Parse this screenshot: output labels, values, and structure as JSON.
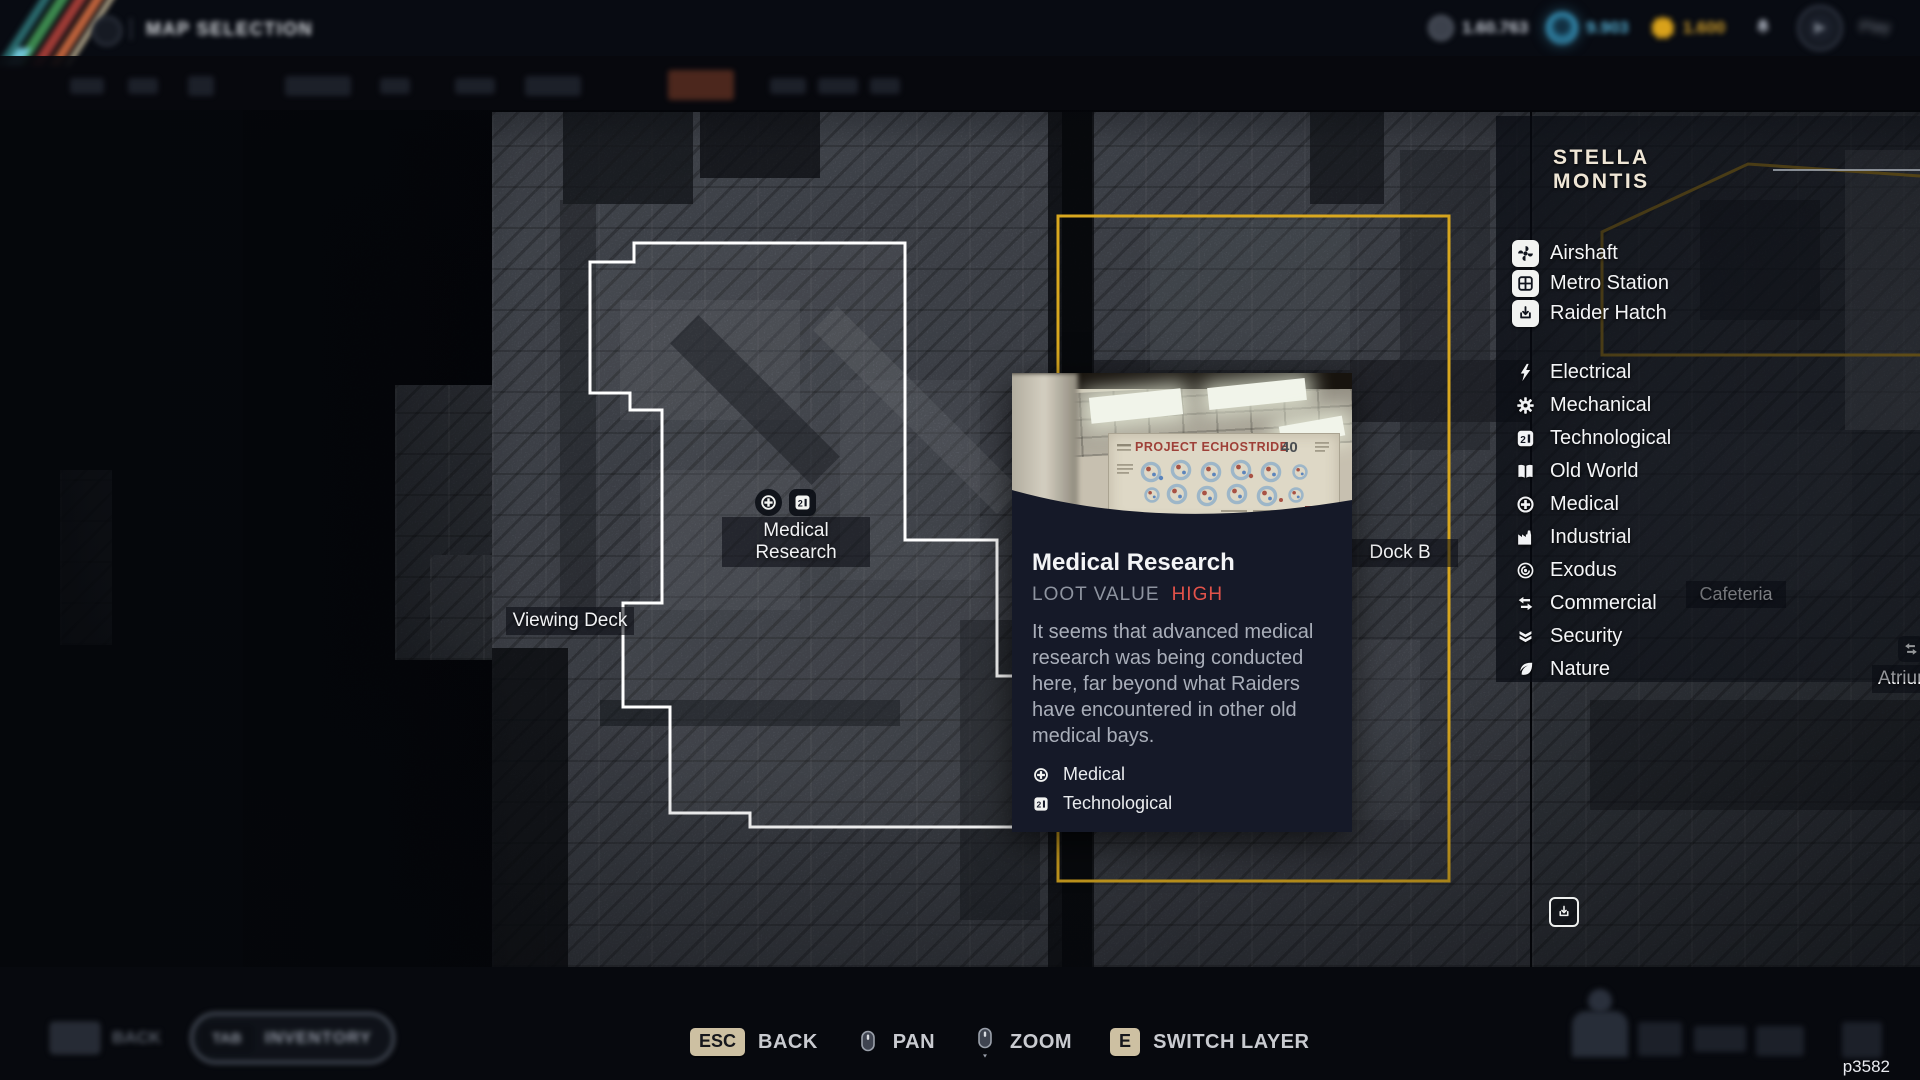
{
  "top_bar": {
    "title": "MAP SELECTION",
    "currencies": [
      {
        "icon": "coin-icon",
        "value": "1.60.763"
      },
      {
        "icon": "energy-orb-icon",
        "value": "9.903",
        "color": "#54aed2"
      },
      {
        "icon": "gold-gear-icon",
        "value": "1.600",
        "color": "#d2a02b"
      }
    ],
    "play_label": "Play"
  },
  "background_hud": {
    "back_label": "BACK",
    "inventory_key": "TAB",
    "inventory_label": "INVENTORY"
  },
  "map": {
    "labels": {
      "medical_research": "Medical Research",
      "viewing_deck": "Viewing Deck",
      "dock_b": "Dock B",
      "cafeteria": "Cafeteria",
      "atrium": "Atrium"
    },
    "colors": {
      "selection": "#d9a81f",
      "room_outline": "#ffffff"
    }
  },
  "tooltip": {
    "title": "Medical Research",
    "loot_label": "LOOT VALUE",
    "loot_value": "HIGH",
    "loot_color": "#e2524a",
    "description": "It seems that advanced medical research was being conducted here, far beyond what Raiders have encountered in other old medical bays.",
    "photo": {
      "poster_title": "PROJECT ECHOSTRIDE",
      "poster_number": "40"
    },
    "tags": [
      {
        "icon": "medical-icon",
        "label": "Medical"
      },
      {
        "icon": "technological-icon",
        "label": "Technological"
      }
    ]
  },
  "legend": {
    "title": "STELLA MONTIS",
    "markers": [
      {
        "icon": "airshaft-icon",
        "label": "Airshaft"
      },
      {
        "icon": "metro-station-icon",
        "label": "Metro Station"
      },
      {
        "icon": "raider-hatch-icon",
        "label": "Raider Hatch"
      }
    ],
    "categories": [
      {
        "icon": "electrical-icon",
        "label": "Electrical"
      },
      {
        "icon": "mechanical-icon",
        "label": "Mechanical"
      },
      {
        "icon": "technological-icon",
        "label": "Technological"
      },
      {
        "icon": "old-world-icon",
        "label": "Old World"
      },
      {
        "icon": "medical-icon",
        "label": "Medical"
      },
      {
        "icon": "industrial-icon",
        "label": "Industrial"
      },
      {
        "icon": "exodus-icon",
        "label": "Exodus"
      },
      {
        "icon": "commercial-icon",
        "label": "Commercial"
      },
      {
        "icon": "security-icon",
        "label": "Security"
      },
      {
        "icon": "nature-icon",
        "label": "Nature"
      }
    ]
  },
  "hints": [
    {
      "key": "ESC",
      "label": "BACK"
    },
    {
      "icon": "mouse-pan-icon",
      "label": "PAN"
    },
    {
      "icon": "mouse-zoom-icon",
      "label": "ZOOM"
    },
    {
      "key": "E",
      "label": "SWITCH LAYER"
    }
  ],
  "player_tag": "p3582"
}
